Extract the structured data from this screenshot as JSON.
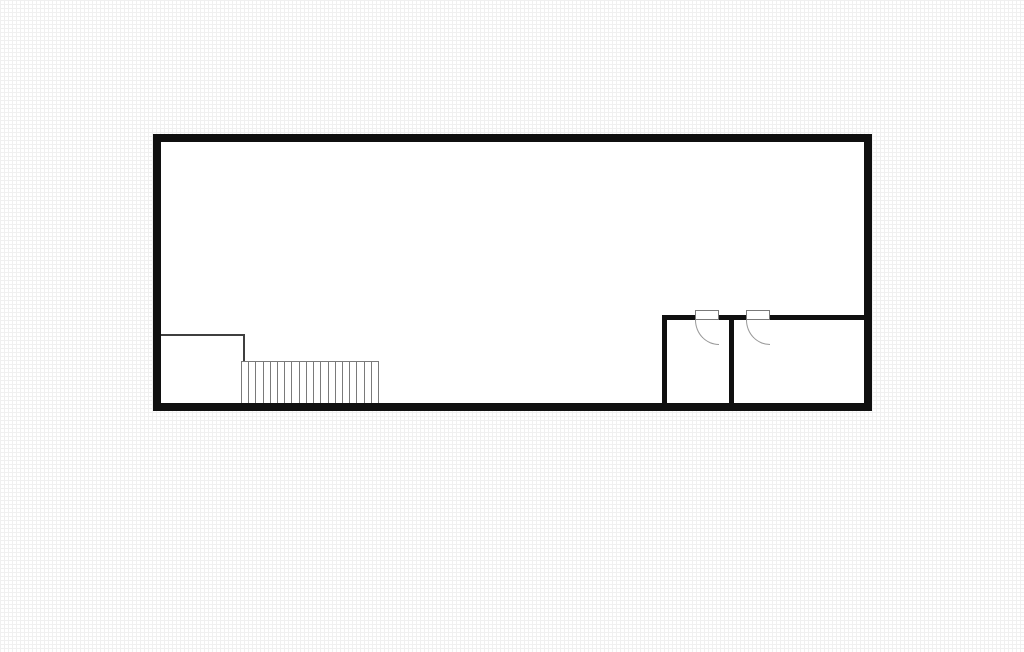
{
  "canvas": {
    "width": 1024,
    "height": 652,
    "background_color": "#ffffff",
    "grid_line_color": "#f0f0f0",
    "grid_cell_px": 4
  },
  "floor_plan": {
    "wall_color": "#101010",
    "door_line_color": "#7a7a7a",
    "door_arc_color": "#999999",
    "outer_wall": {
      "x": 153,
      "y": 134,
      "width": 719,
      "height": 277,
      "thickness": 8,
      "color": "#101010",
      "fill": "#ffffff"
    },
    "landing": {
      "color": "#3f3f3f",
      "lines": [
        {
          "id": "stair-landing-line-horizontal",
          "x": 161,
          "y": 334,
          "w": 83,
          "h": 2
        },
        {
          "id": "stair-landing-line-vertical",
          "x": 242.5,
          "y": 334,
          "w": 2,
          "h": 27
        }
      ]
    },
    "stairs": {
      "x": 241,
      "y": 361,
      "width": 138,
      "height": 42,
      "treads": 19,
      "line_color": "#7a7a7a"
    },
    "interior_walls": [
      {
        "id": "rooms-top-wall-segment-west",
        "x": 662,
        "y": 315,
        "w": 32.5,
        "h": 5
      },
      {
        "id": "rooms-top-wall-segment-middle",
        "x": 718.5,
        "y": 315,
        "w": 27,
        "h": 5
      },
      {
        "id": "rooms-top-wall-segment-east",
        "x": 769.5,
        "y": 315,
        "w": 94.5,
        "h": 5
      },
      {
        "id": "left-room-west-wall",
        "x": 662,
        "y": 315,
        "w": 5,
        "h": 88
      },
      {
        "id": "room-divider-wall",
        "x": 729,
        "y": 315,
        "w": 5,
        "h": 88
      }
    ],
    "doors": [
      {
        "id": "left-room-door",
        "leaf": {
          "x": 694.5,
          "y": 310,
          "w": 24,
          "h": 10
        },
        "swing": {
          "x": 694.5,
          "y": 319.5,
          "w": 24,
          "h": 25
        }
      },
      {
        "id": "right-room-door",
        "leaf": {
          "x": 745.5,
          "y": 310,
          "w": 24,
          "h": 10
        },
        "swing": {
          "x": 745.5,
          "y": 319.5,
          "w": 24,
          "h": 25
        }
      }
    ]
  }
}
